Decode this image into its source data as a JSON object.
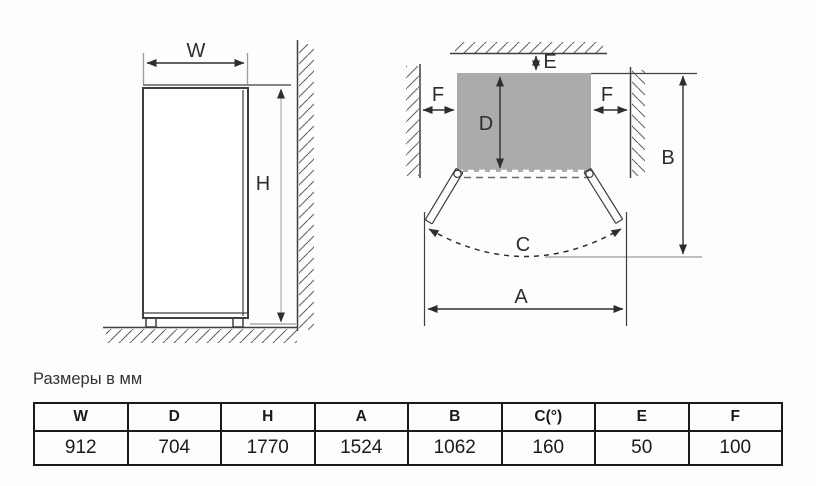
{
  "caption": "Размеры в мм",
  "diagram": {
    "front_view": {
      "width_label": "W",
      "height_label": "H"
    },
    "top_view": {
      "depth_label": "D",
      "rear_gap_label": "E",
      "side_gap_left_label": "F",
      "side_gap_right_label": "F",
      "open_depth_label": "B",
      "door_angle_label": "C",
      "open_width_label": "A"
    },
    "colors": {
      "outline": "#3f3f3f",
      "body_fill": "#ababab",
      "dim_line_light": "#b6b6b6",
      "extension_line": "#9c9c9c",
      "table_border": "#1a1a1a"
    }
  },
  "table": {
    "headers": [
      "W",
      "D",
      "H",
      "A",
      "B",
      "C(°)",
      "E",
      "F"
    ],
    "values": [
      "912",
      "704",
      "1770",
      "1524",
      "1062",
      "160",
      "50",
      "100"
    ]
  }
}
